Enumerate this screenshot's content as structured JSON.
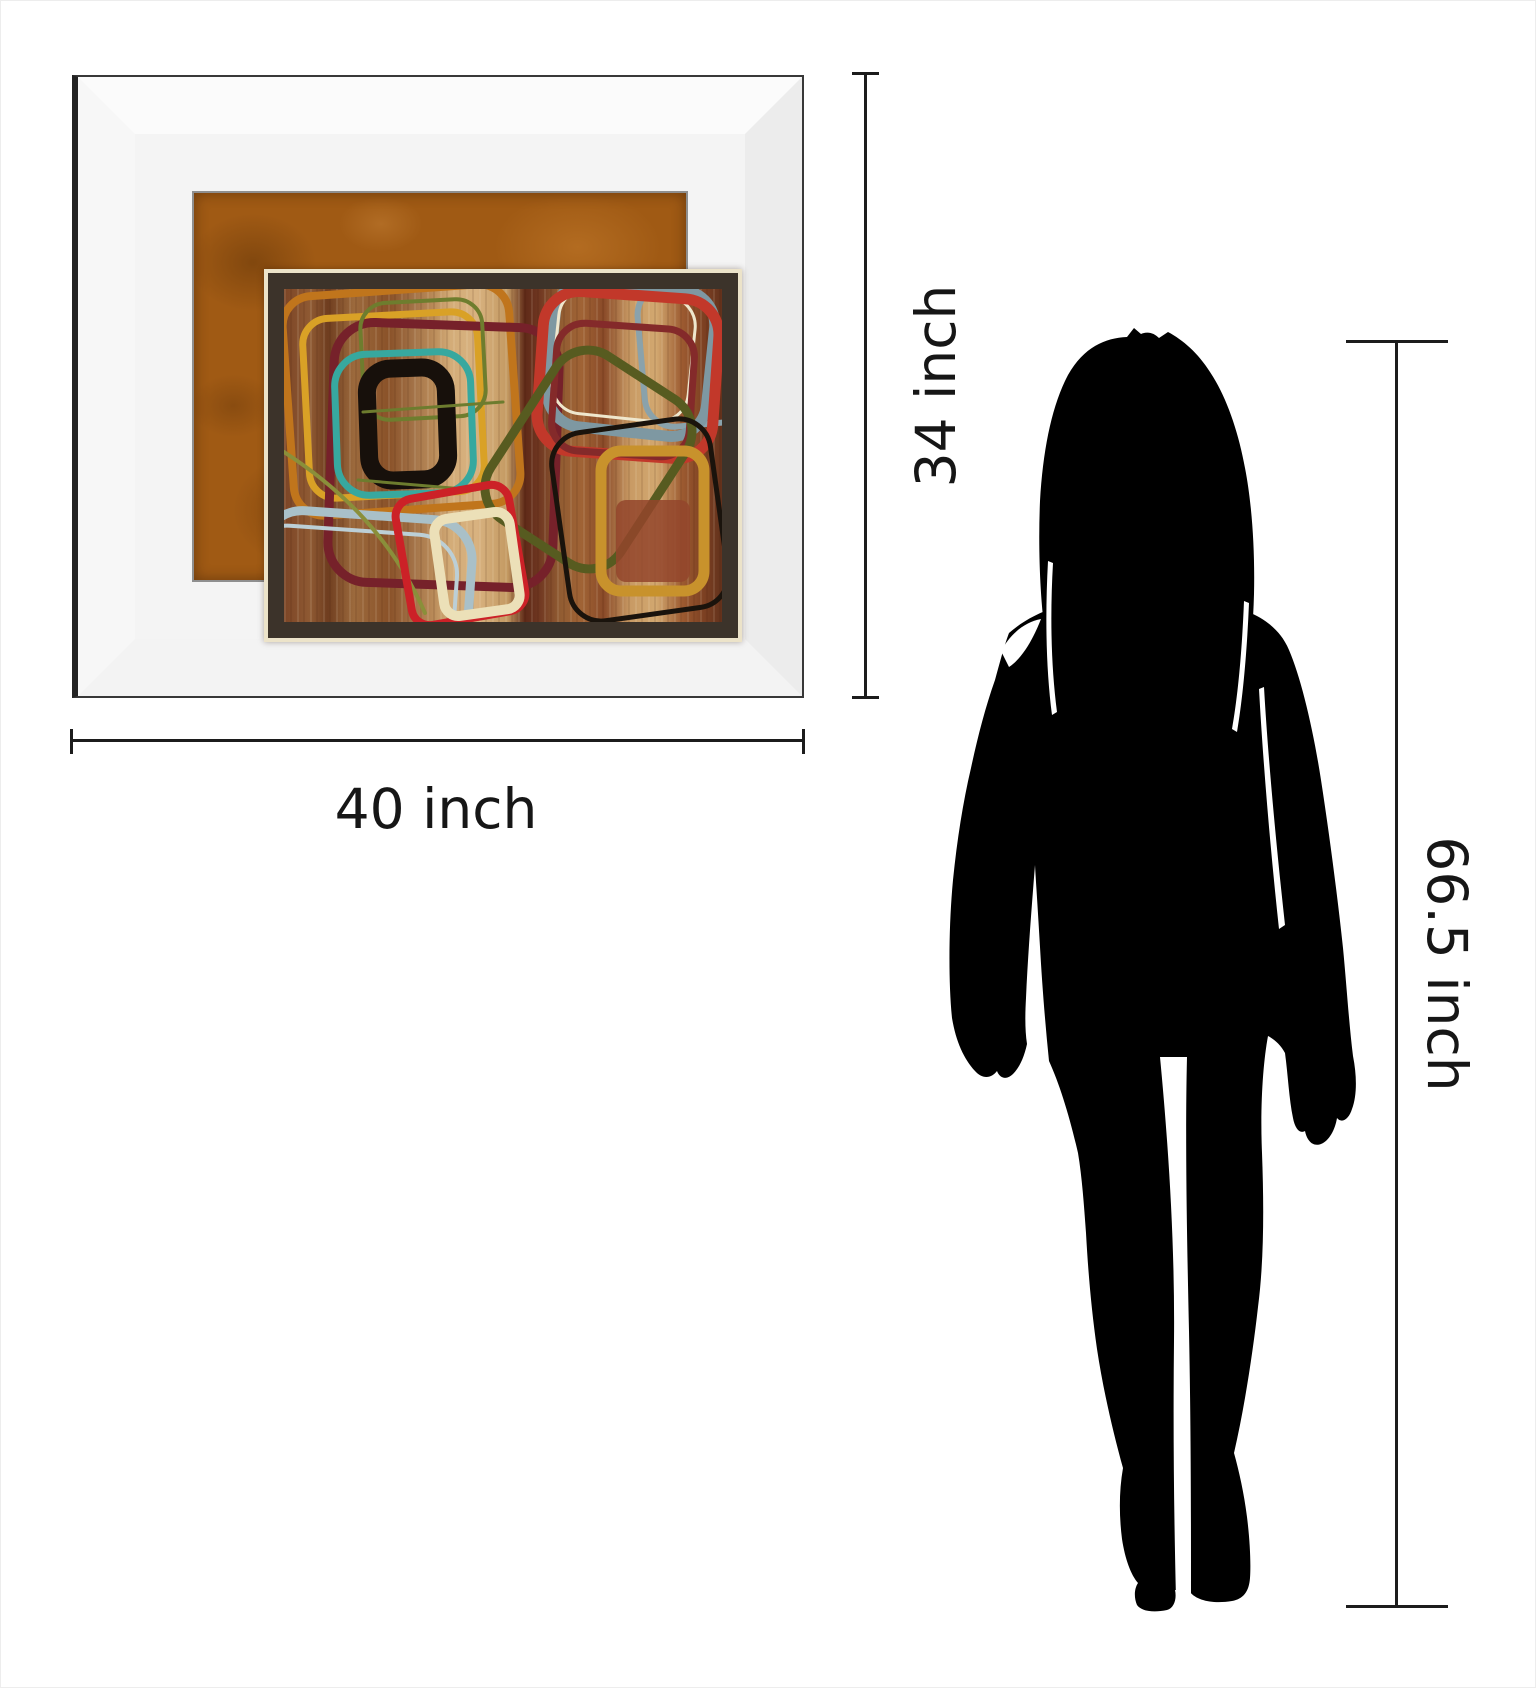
{
  "labels": {
    "art_width": "40 inch",
    "art_height": "34 inch",
    "person_height": "66.5 inch"
  },
  "style": {
    "dim_line_color": "#1c1c1c",
    "dim_text_color": "#161616",
    "matte_color": "#a05a14",
    "frame_bevel_color": "#f3f3f3",
    "print_mat_dark": "#3c332a",
    "print_mat_cream": "#ece3c9",
    "silhouette_color": "#000000"
  },
  "art": {
    "description": "abstract retro rounded-rectangle painting",
    "shapes": [
      {
        "type": "rect",
        "x": 225,
        "y": 230,
        "w": 227,
        "h": 220,
        "rx": 30,
        "rot": -4,
        "stroke": "#c0751c",
        "sw": 8
      },
      {
        "type": "rect",
        "x": 243,
        "y": 255,
        "w": 175,
        "h": 180,
        "rx": 26,
        "rot": -3,
        "stroke": "#d9a126",
        "sw": 7
      },
      {
        "type": "rect",
        "x": 268,
        "y": 265,
        "w": 225,
        "h": 260,
        "rx": 40,
        "rot": 2,
        "stroke": "#76212a",
        "sw": 9
      },
      {
        "type": "rect",
        "x": 299,
        "y": 241,
        "w": 122,
        "h": 117,
        "rx": 26,
        "rot": -3,
        "stroke": "#6e7d2e",
        "sw": 4
      },
      {
        "type": "rect",
        "x": 273,
        "y": 293,
        "w": 136,
        "h": 141,
        "rx": 32,
        "rot": -2,
        "stroke": "#37a89f",
        "sw": 7
      },
      {
        "type": "rect",
        "x": 305,
        "y": 308,
        "w": 79,
        "h": 112,
        "rx": 24,
        "rot": -2,
        "stroke": "#17100b",
        "sw": 18
      },
      {
        "type": "path",
        "d": "M300,352 L440,342",
        "stroke": "#6d7c2e",
        "sw": 3
      },
      {
        "type": "path",
        "d": "M295,420 L412,430",
        "stroke": "#6d7c2e",
        "sw": 3
      },
      {
        "type": "rect",
        "x": 578,
        "y": 222,
        "w": 125,
        "h": 142,
        "rx": 30,
        "rot": -5,
        "stroke": "#8aa2ab",
        "sw": 6
      },
      {
        "type": "rect",
        "x": 488,
        "y": 225,
        "w": 160,
        "h": 147,
        "rx": 35,
        "rot": 6,
        "stroke": "#7e98a2",
        "sw": 11
      },
      {
        "type": "rect",
        "x": 492,
        "y": 232,
        "w": 137,
        "h": 126,
        "rx": 30,
        "rot": 6,
        "stroke": "#efe7cd",
        "sw": 3
      },
      {
        "type": "rect",
        "x": 477,
        "y": 235,
        "w": 176,
        "h": 160,
        "rx": 36,
        "rot": 4,
        "stroke": "#c2382a",
        "sw": 11
      },
      {
        "type": "rect",
        "x": 491,
        "y": 266,
        "w": 138,
        "h": 128,
        "rx": 28,
        "rot": 4,
        "stroke": "#842a2a",
        "sw": 7
      },
      {
        "type": "rect",
        "x": 448,
        "y": 302,
        "w": 155,
        "h": 195,
        "rx": 38,
        "rot": 33,
        "stroke": "#575b20",
        "sw": 9
      },
      {
        "type": "rect",
        "x": 497,
        "y": 365,
        "w": 160,
        "h": 190,
        "rx": 32,
        "rot": -8,
        "stroke": "#1a130c",
        "sw": 5
      },
      {
        "type": "rect",
        "x": 553,
        "y": 440,
        "w": 74,
        "h": 82,
        "rx": 10,
        "rot": 0,
        "fill": "#93452b",
        "opacity": 0.85
      },
      {
        "type": "rect",
        "x": 538,
        "y": 391,
        "w": 103,
        "h": 140,
        "rx": 20,
        "rot": 0,
        "stroke": "#c8922c",
        "sw": 11
      },
      {
        "type": "rect",
        "x": 180,
        "y": 470,
        "w": 210,
        "h": 200,
        "rx": 40,
        "rot": 4,
        "stroke": "#bccfd6",
        "sw": 4
      },
      {
        "type": "rect",
        "x": 195,
        "y": 455,
        "w": 210,
        "h": 200,
        "rx": 40,
        "rot": 4,
        "stroke": "#a9c0c8",
        "sw": 9
      },
      {
        "type": "path",
        "d": "M221,392 C280,430 330,480 362,553",
        "stroke": "#8a8f3a",
        "sw": 4
      },
      {
        "type": "rect",
        "x": 340,
        "y": 431,
        "w": 115,
        "h": 128,
        "rx": 18,
        "rot": -10,
        "stroke": "#cc2127",
        "sw": 8
      },
      {
        "type": "rect",
        "x": 376,
        "y": 455,
        "w": 76,
        "h": 98,
        "rx": 14,
        "rot": -8,
        "stroke": "#ece0b8",
        "sw": 10
      }
    ]
  },
  "figure": {
    "description": "standing woman silhouette",
    "shapes": [
      {
        "type": "path",
        "fill": "#000000",
        "d": "M1126,336 L1133,327 L1140,333 C1147,330 1153,332 1158,337 L1167,331 C1182,339 1197,352 1209,371 C1225,395 1237,429 1244,467 C1251,503 1254,549 1253,593 C1252,629 1249,661 1243,691 C1248,712 1250,730 1247,748 L1240,764 L1234,744 L1229,770 C1221,753 1215,740 1213,721 C1201,737 1187,748 1173,751 C1153,754 1133,749 1117,739 C1105,731 1095,722 1089,711 L1083,744 L1077,717 L1069,740 L1063,701 C1055,689 1049,668 1045,640 C1039,600 1037,548 1039,500 C1042,448 1051,404 1067,374 C1083,346 1104,337 1126,336 Z"
      },
      {
        "type": "path",
        "fill": "#000000",
        "d": "M1008,632 C1032,611 1064,600 1104,597 C1154,592 1208,596 1247,611 C1265,618 1280,630 1288,649 C1300,677 1312,727 1320,779 C1328,831 1336,891 1342,947 C1346,989 1348,1023 1352,1055 C1356,1075 1356,1095 1351,1108 C1348,1118 1341,1123 1336,1117 C1334,1129 1328,1140 1320,1143 C1312,1146 1306,1140 1304,1130 C1299,1133 1294,1128 1292,1117 C1288,1098 1287,1074 1284,1052 C1280,1044 1273,1038 1267,1035 C1262,1062 1259,1105 1261,1152 C1263,1206 1263,1260 1257,1306 C1252,1350 1244,1404 1233,1452 C1238,1470 1243,1492 1246,1516 C1249,1540 1250,1563 1249,1577 C1248,1591 1242,1598 1231,1600 C1213,1603 1196,1600 1189,1591 L1174,1589 C1176,1598 1173,1607 1166,1609 C1152,1612 1140,1610 1136,1604 C1133,1597 1133,1588 1137,1582 C1130,1574 1124,1558 1121,1538 C1118,1514 1118,1490 1122,1467 C1112,1431 1102,1388 1096,1348 C1090,1306 1087,1268 1085,1232 C1083,1204 1081,1176 1077,1152 C1069,1117 1059,1084 1048,1060 C1044,1021 1041,981 1039,946 C1037,911 1035,882 1034,864 C1031,902 1027,952 1025,997 C1024,1015 1024,1030 1026,1043 C1023,1057 1018,1067 1012,1073 C1006,1079 999,1078 996,1070 C990,1078 981,1078 974,1070 C963,1058 955,1041 951,1017 C947,977 948,921 952,879 C956,839 962,801 970,767 C976,739 984,707 994,679 C999,661 1003,645 1008,632 Z"
      },
      {
        "type": "path",
        "fill": "#ffffff",
        "d": "M1159,1056 L1186,1056 C1184,1140 1186,1240 1188,1330 C1190,1430 1190,1520 1190,1598 L1175,1598 C1173,1515 1172,1430 1173,1340 C1174,1240 1167,1140 1159,1056 Z"
      },
      {
        "type": "path",
        "fill": "#ffffff",
        "d": "M1258,688 C1262,760 1269,845 1278,928 L1284,924 C1275,842 1267,756 1263,686 Z"
      },
      {
        "type": "path",
        "fill": "#ffffff",
        "d": "M1047,560 C1044,615 1045,668 1051,714 L1056,711 C1050,665 1049,614 1052,562 Z"
      },
      {
        "type": "path",
        "fill": "#ffffff",
        "d": "M1243,600 C1241,650 1237,694 1231,728 L1236,731 C1242,696 1246,650 1248,602 Z"
      },
      {
        "type": "path",
        "fill": "#ffffff",
        "d": "M1000,650 C1010,632 1024,621 1040,618 C1031,641 1020,658 1008,666 Z"
      }
    ]
  }
}
